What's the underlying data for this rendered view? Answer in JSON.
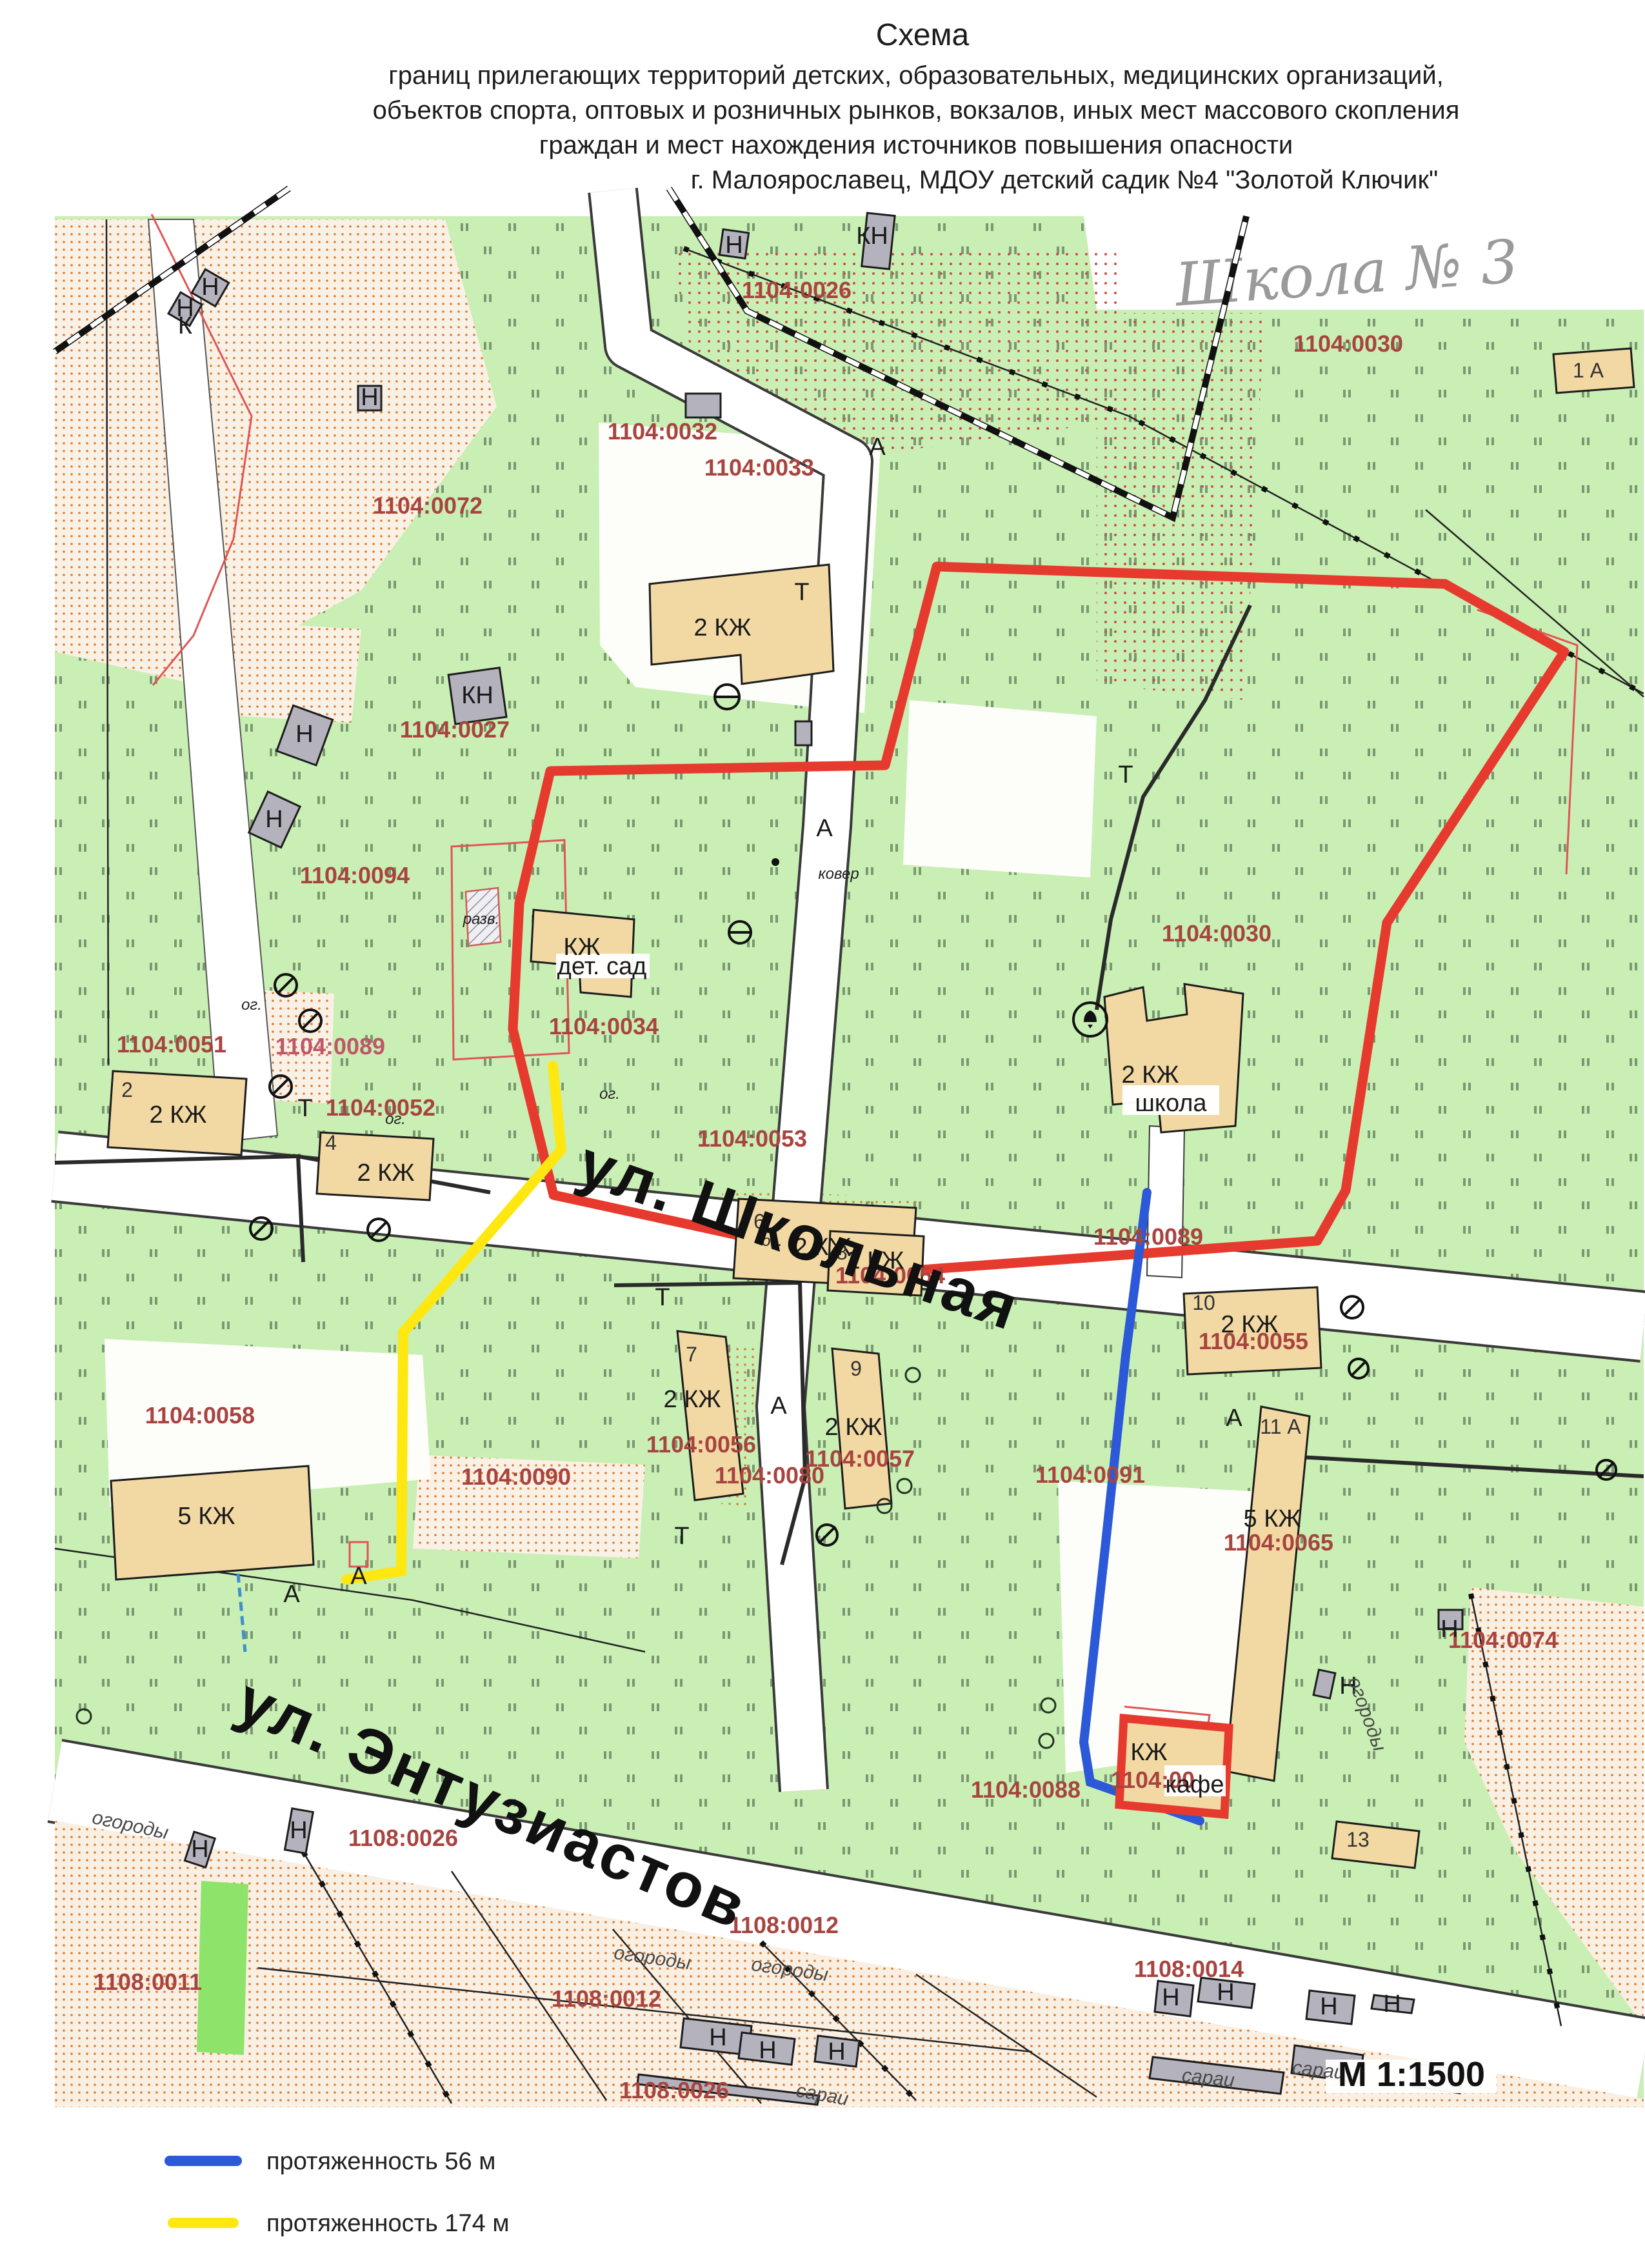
{
  "doc": {
    "title_lines": [
      "Схема",
      "границ прилегающих территорий детских, образовательных, медицинских организаций,",
      "объектов спорта, оптовых и розничных рынков, вокзалов, иных мест массового скопления",
      "граждан и мест нахождения источников повышения опасности",
      "г. Малоярославец, МДОУ детский садик №4 \"Золотой Ключик\""
    ],
    "handwritten_note": "Школа № 3"
  },
  "map": {
    "streets": {
      "shkolnaya": "ул. Школьная",
      "entuziastov": "ул. Энтузиастов"
    },
    "scale_text": "М 1:1500",
    "parcels": {
      "p1104_0026": "1104:0026",
      "p1104_0030": "1104:0030",
      "p1104_0032": "1104:0032",
      "p1104_0033": "1104:0033",
      "p1104_0072": "1104:0072",
      "p1104_0027": "1104:0027",
      "p1104_0094": "1104:0094",
      "p1104_0034": "1104:0034",
      "p1104_0051": "1104:0051",
      "p1104_0089": "1104:0089",
      "p1104_0052": "1104:0052",
      "p1104_0053": "1104:0053",
      "p1104_0054": "1104:0054",
      "p1104_0055": "1104:0055",
      "p1104_0056": "1104:0056",
      "p1104_0057": "1104:0057",
      "p1104_0080": "1104:0080",
      "p1104_0058": "1104:0058",
      "p1104_0090": "1104:0090",
      "p1104_0091": "1104:0091",
      "p1104_0065": "1104:0065",
      "p1104_0074": "1104:0074",
      "p1104_0088": "1104:0088",
      "p_cafe_part": "1104:00",
      "p1108_0026": "1108:0026",
      "p1108_0012": "1108:0012",
      "p1108_0011": "1108:0011",
      "p1108_0014": "1108:0014"
    },
    "buildings": {
      "lbl_2kzh": "2 КЖ",
      "lbl_5kzh": "5 КЖ",
      "lbl_kzh": "КЖ",
      "lbl_kn": "КН",
      "lbl_n": "Н",
      "school": "школа",
      "kindergarten": "дет. сад",
      "cafe": "кафе",
      "razv": "разв.",
      "n2": "2",
      "n4": "4",
      "n6": "6",
      "n7": "7",
      "n8": "8",
      "n9": "9",
      "n10": "10",
      "n11a": "11 А",
      "n13": "13",
      "n1a": "1 А"
    },
    "misc": {
      "lbl_a": "А",
      "lbl_t": "Т",
      "lbl_k": "К",
      "lbl_og": "ог.",
      "lbl_ogorody": "огороды",
      "lbl_sarai": "сараи",
      "lbl_kover": "ковер"
    }
  },
  "legend": {
    "items": [
      {
        "color": "#2b59d8",
        "label": "протяженность 56 м"
      },
      {
        "color": "#ffe712",
        "label": "протяженность 174 м"
      }
    ]
  },
  "colors": {
    "map_green": "#c9efb4",
    "accent_green": "#8ee46a",
    "building_tan": "#f2d9a4",
    "building_gray": "#b4b2bc",
    "boundary_red": "#e63a2e",
    "parcel_label_red": "#a84440",
    "route_blue": "#2b59d8",
    "route_yellow": "#ffe712"
  }
}
